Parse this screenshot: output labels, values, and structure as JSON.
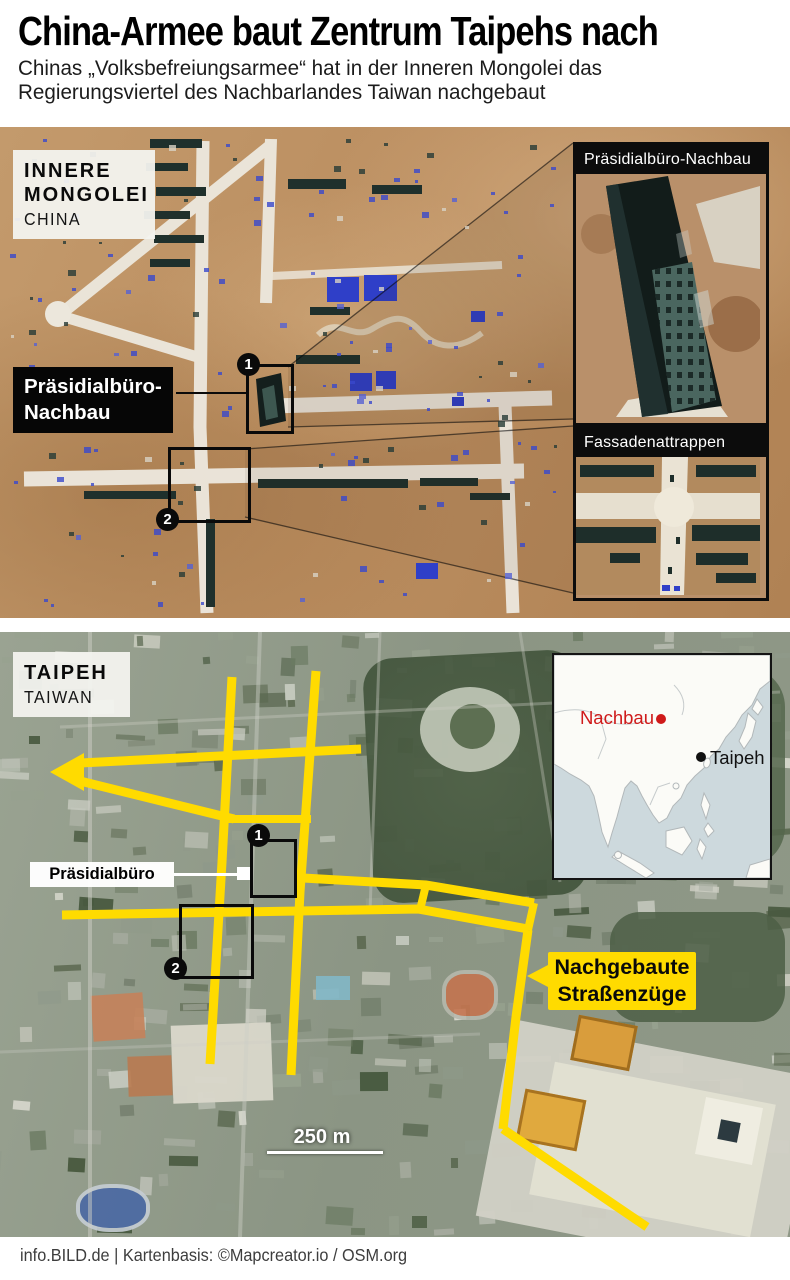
{
  "header": {
    "title": "China-Armee baut Zentrum Taipehs nach",
    "subtitle_line1": "Chinas „Volksbefreiungsarmee“ hat in der Inneren Mongolei das",
    "subtitle_line2": "Regierungsviertel des Nachbarlandes Taiwan nachgebaut"
  },
  "map_top": {
    "region": {
      "line1": "INNERE",
      "line2": "MONGOLEI",
      "country": "CHINA"
    },
    "callout": {
      "line1": "Präsidialbüro-",
      "line2": "Nachbau"
    },
    "marker1": "1",
    "marker2": "2",
    "inset1_title": "Präsidialbüro-Nachbau",
    "inset2_title": "Fassadenattrappen"
  },
  "map_bottom": {
    "region": {
      "city": "TAIPEH",
      "country": "TAIWAN"
    },
    "building_label": "Präsidialbüro",
    "marker1": "1",
    "marker2": "2",
    "streets_label": {
      "line1": "Nachgebaute",
      "line2": "Straßenzüge"
    },
    "scale_label": "250 m",
    "inset_map": {
      "replica_label": "Nachbau",
      "city_label": "Taipeh"
    }
  },
  "footer": {
    "credit": "info.BILD.de | Kartenbasis: ©Mapcreator.io / OSM.org"
  },
  "colors": {
    "highlight_yellow": "#ffdb00",
    "accent_red": "#cf1a1a",
    "marker_black": "#0a0a0a"
  }
}
